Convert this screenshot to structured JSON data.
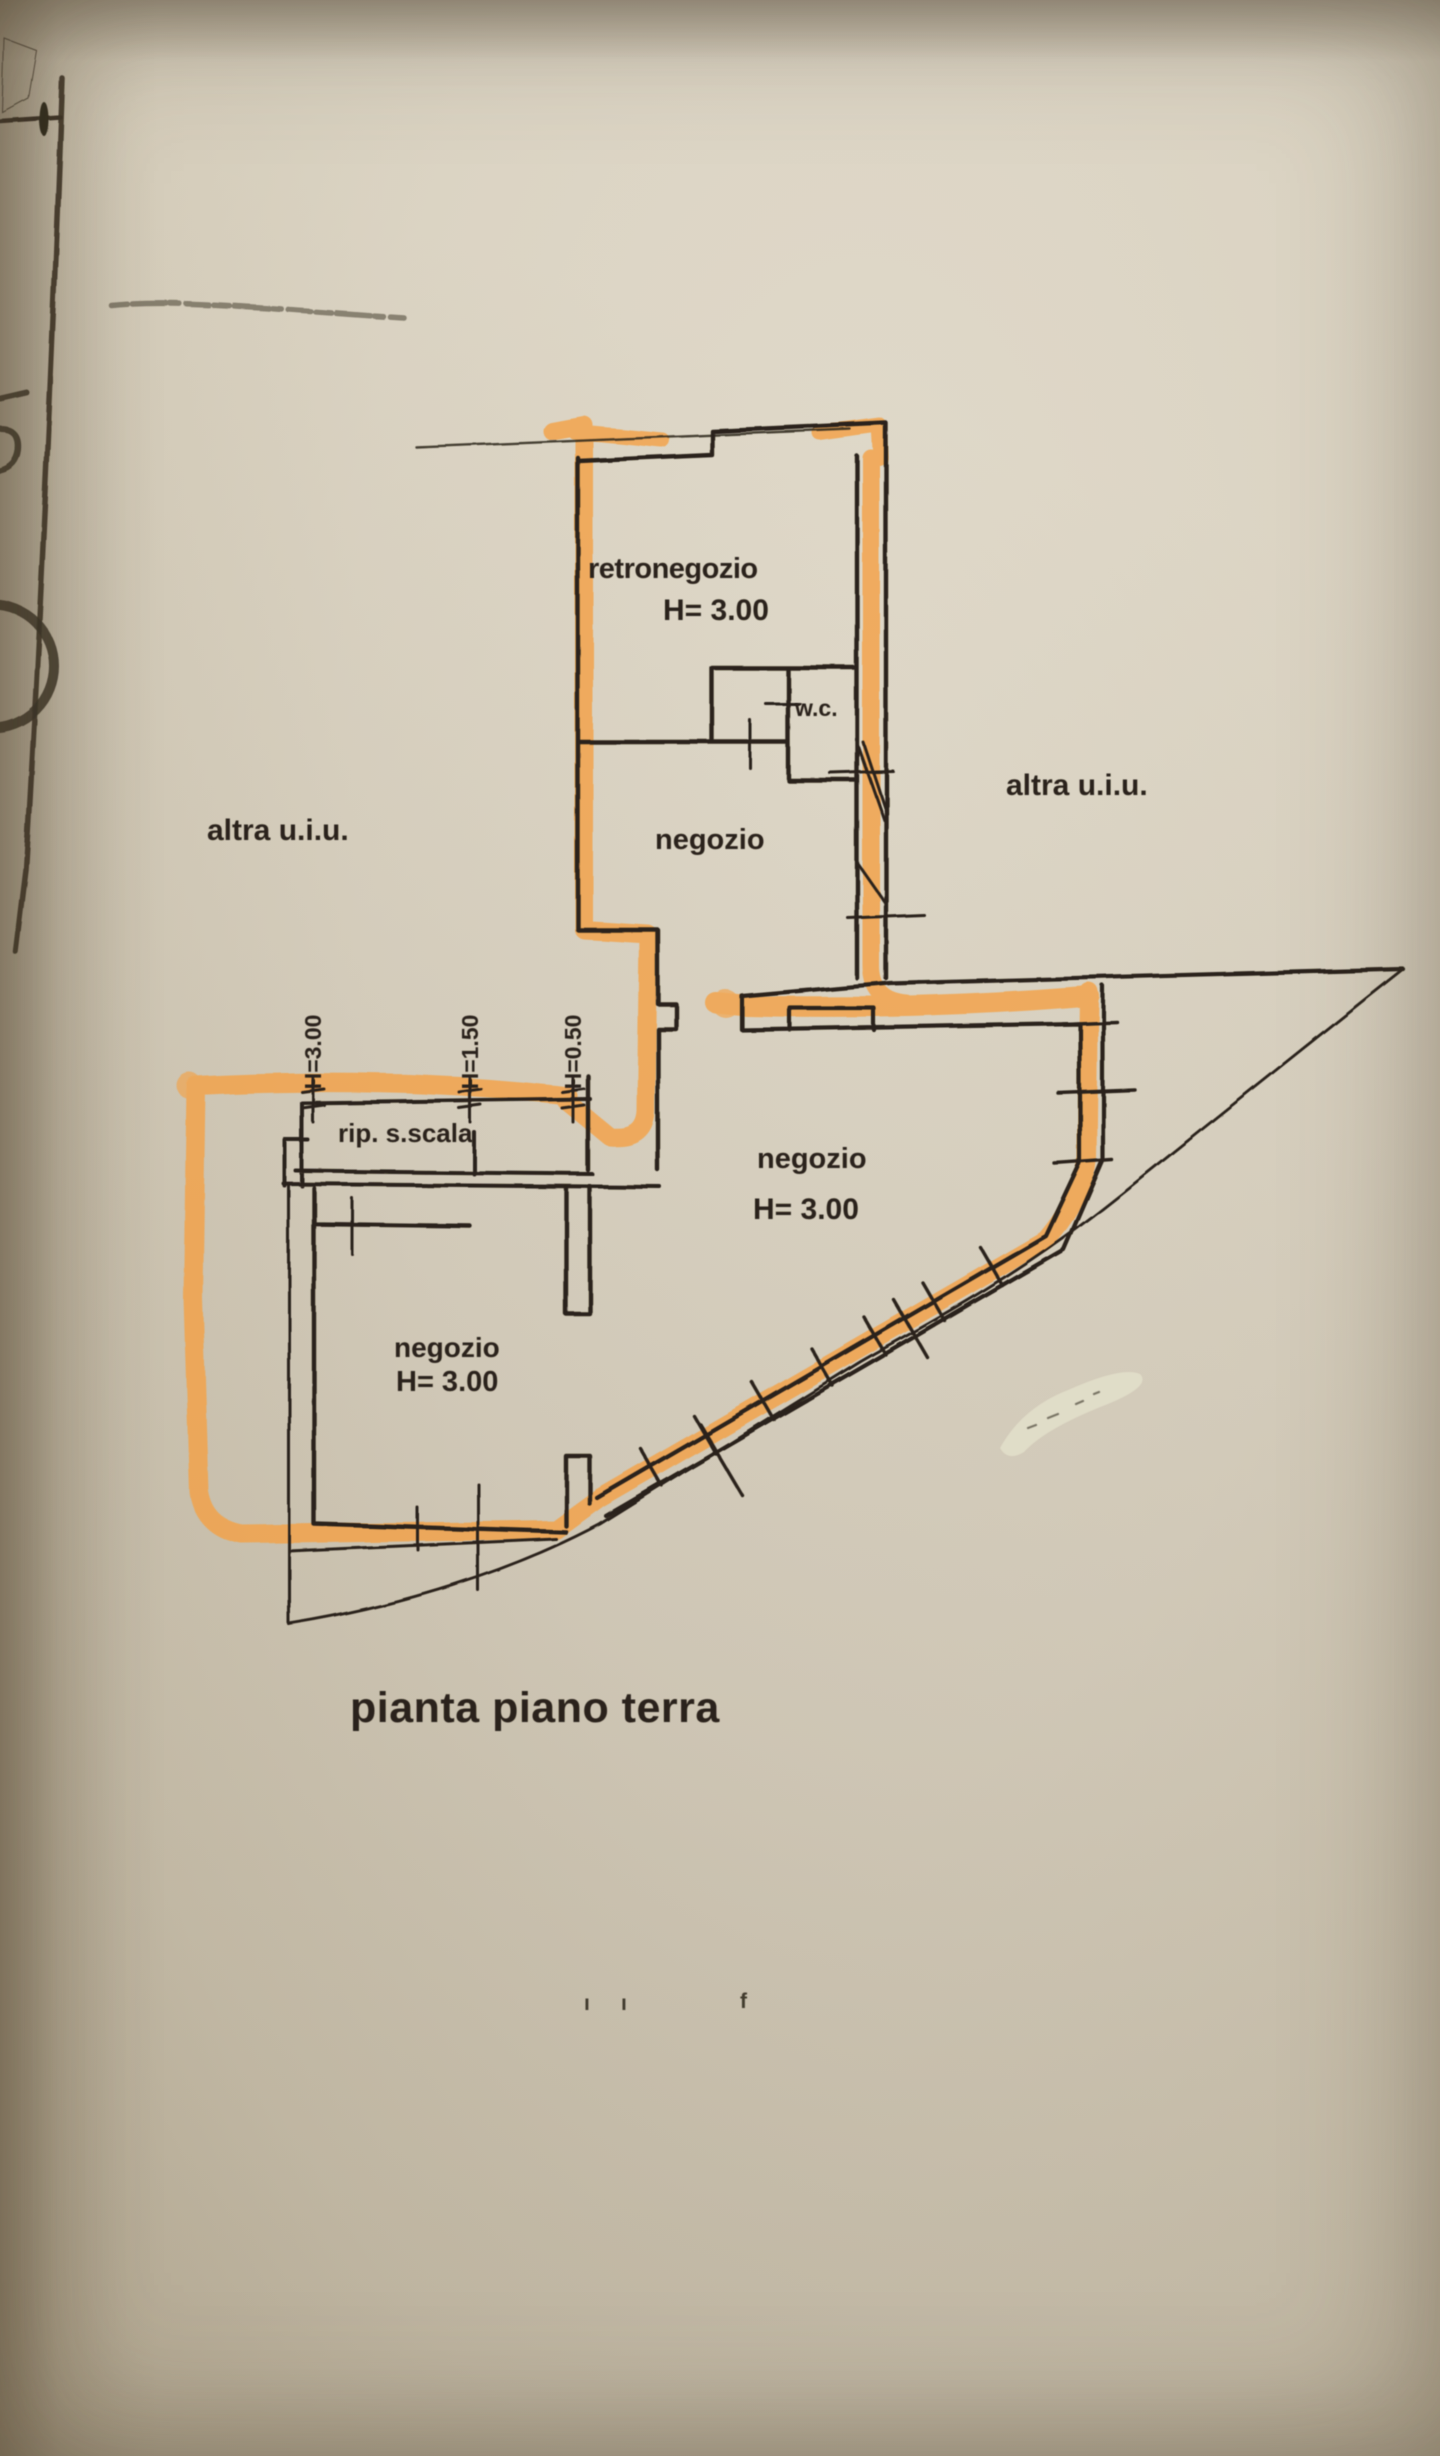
{
  "document_type": "scanned cadastral floor plan",
  "colors": {
    "paper": "#d6cebc",
    "ink": "#2b241a",
    "highlighter": "#f4a145",
    "whiteout": "#e0ddc8",
    "scan_edge": "#3a3226",
    "smudge": "#a2977f"
  },
  "plan": {
    "rooms": {
      "retronegozio": {
        "label": "retronegozio",
        "height": "H= 3.00"
      },
      "wc": {
        "label": "w.c."
      },
      "negozio_upper": {
        "label": "negozio"
      },
      "rip_scala": {
        "label": "rip. s.scala"
      },
      "negozio_right": {
        "label": "negozio",
        "height": "H= 3.00"
      },
      "negozio_lower": {
        "label": "negozio",
        "height": "H= 3.00"
      }
    },
    "annotations": {
      "altra_left": "altra u.i.u.",
      "altra_right": "altra u.i.u.",
      "h_300": "H=3.00",
      "h_150": "H=1.50",
      "h_050": "H=0.50"
    },
    "caption": "pianta piano terra",
    "stray_marks": {
      "m1": "ı",
      "m2": "ı",
      "m3": "f"
    }
  }
}
